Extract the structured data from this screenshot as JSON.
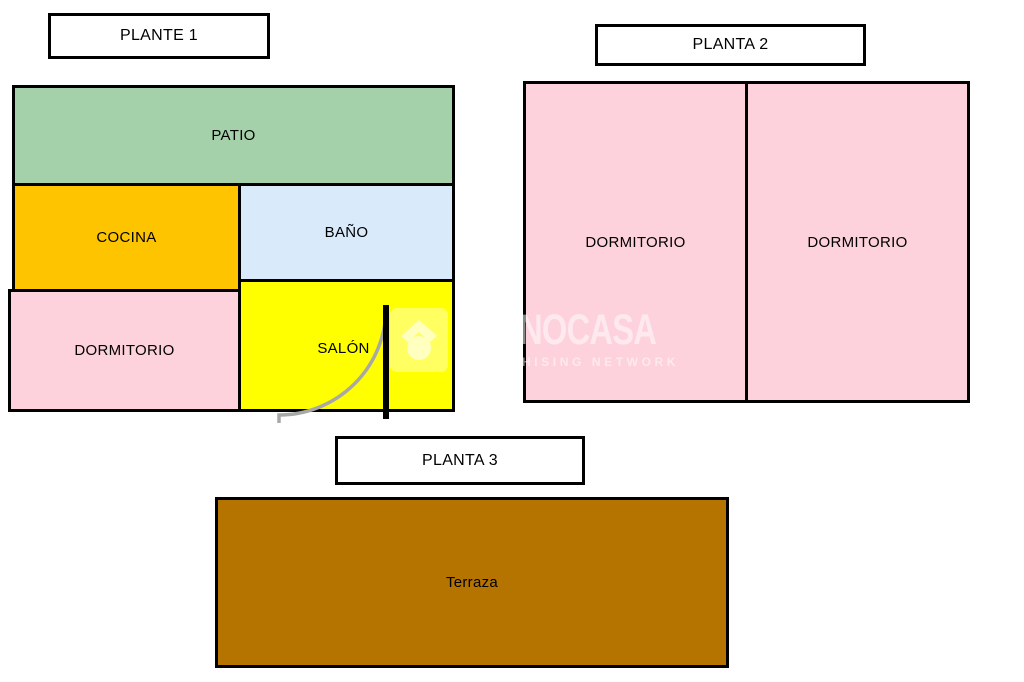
{
  "plans": [
    {
      "label": "PLANTE 1",
      "rooms": [
        {
          "name": "PATIO",
          "color": "#a4d0aa"
        },
        {
          "name": "COCINA",
          "color": "#ffc400"
        },
        {
          "name": "BAÑO",
          "color": "#d9eafb"
        },
        {
          "name": "DORMITORIO",
          "color": "#fdd2dc"
        },
        {
          "name": "SALÓN",
          "color": "#ffff00"
        }
      ]
    },
    {
      "label": "PLANTA 2",
      "rooms": [
        {
          "name": "DORMITORIO",
          "color": "#fdd2dc"
        },
        {
          "name": "DORMITORIO",
          "color": "#fdd2dc"
        }
      ]
    },
    {
      "label": "PLANTA 3",
      "rooms": [
        {
          "name": "Terraza",
          "color": "#b57400"
        }
      ]
    }
  ],
  "watermark": {
    "brand": "TECNOCASA",
    "tagline": "FRANCHISING NETWORK"
  },
  "colors": {
    "wall": "#000000",
    "door_arc": "#a8a8a8",
    "label_box_bg": "#ffffff",
    "text": "#000000",
    "background": "#ffffff"
  }
}
